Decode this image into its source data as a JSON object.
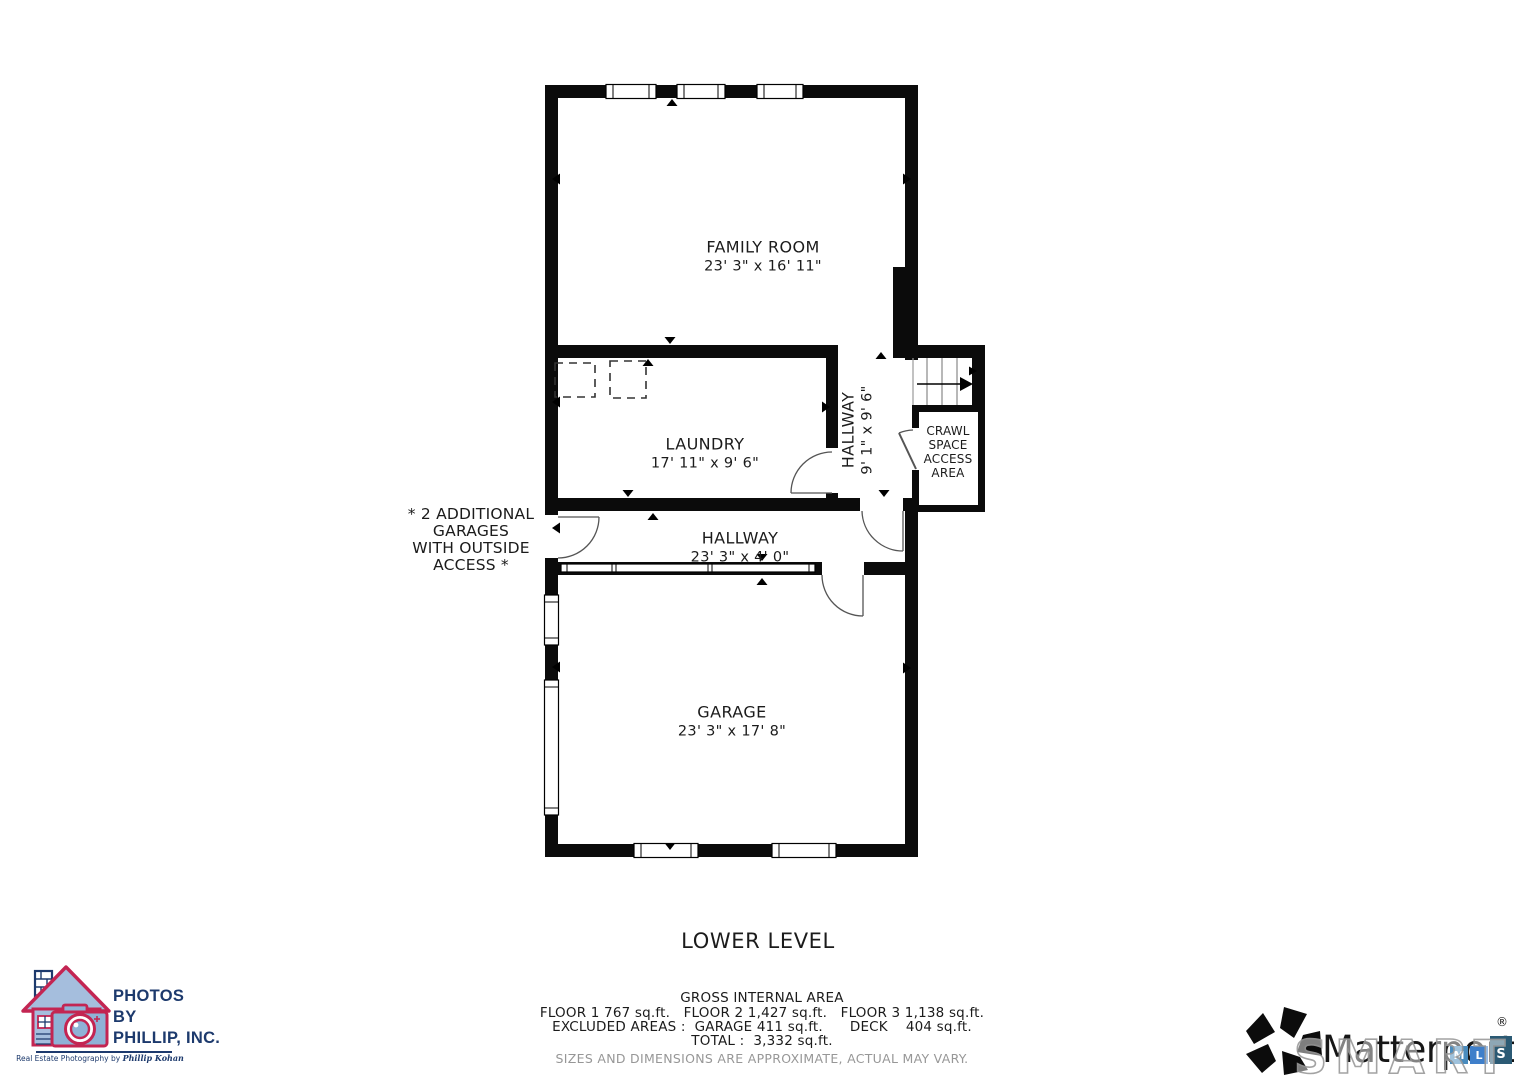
{
  "plan": {
    "level_title": "LOWER LEVEL",
    "rooms": {
      "family_room": {
        "name": "FAMILY ROOM",
        "dims": "23' 3\" x 16' 11\""
      },
      "laundry": {
        "name": "LAUNDRY",
        "dims": "17' 11\" x 9' 6\""
      },
      "hallway_upper": {
        "name": "HALLWAY",
        "dims": "9' 1\" x 9' 6\""
      },
      "crawl_space": {
        "lines": [
          "CRAWL",
          "SPACE",
          "ACCESS",
          "AREA"
        ]
      },
      "hallway_lower": {
        "name": "HALLWAY",
        "dims": "23' 3\" x 4' 0\""
      },
      "garage": {
        "name": "GARAGE",
        "dims": "23' 3\" x 17' 8\""
      }
    },
    "annotation": {
      "lines": [
        "* 2 ADDITIONAL",
        "GARAGES",
        "WITH OUTSIDE",
        "ACCESS *"
      ]
    }
  },
  "footer": {
    "gross_internal_area": "GROSS INTERNAL AREA",
    "floor_areas": "FLOOR 1 767 sq.ft.   FLOOR 2 1,427 sq.ft.   FLOOR 3 1,138 sq.ft.",
    "excluded_areas": "EXCLUDED AREAS :  GARAGE 411 sq.ft.      DECK    404 sq.ft.",
    "total": "TOTAL :  3,332 sq.ft.",
    "disclaimer": "SIZES AND DIMENSIONS ARE APPROXIMATE, ACTUAL MAY VARY."
  },
  "branding": {
    "photographer": {
      "name_line1": "PHOTOS",
      "name_line2": "BY",
      "name_line3": "PHILLIP, INC.",
      "tagline_prefix": "Real Estate Photography by ",
      "tagline_name": "Phillip Kohan",
      "navy": "#1d3a6d",
      "red": "#c32552",
      "house_fill": "#a5bedd",
      "camera_fill": "#8fb2d6"
    },
    "matterport": {
      "wordmark": "Matterport",
      "registered": "®"
    },
    "smartmls": {
      "watermark": "SMART",
      "boxes": [
        "M",
        "L",
        "S"
      ],
      "box_colors": [
        "#4a8cbe",
        "#3f7fca",
        "#2b5a74"
      ]
    }
  }
}
